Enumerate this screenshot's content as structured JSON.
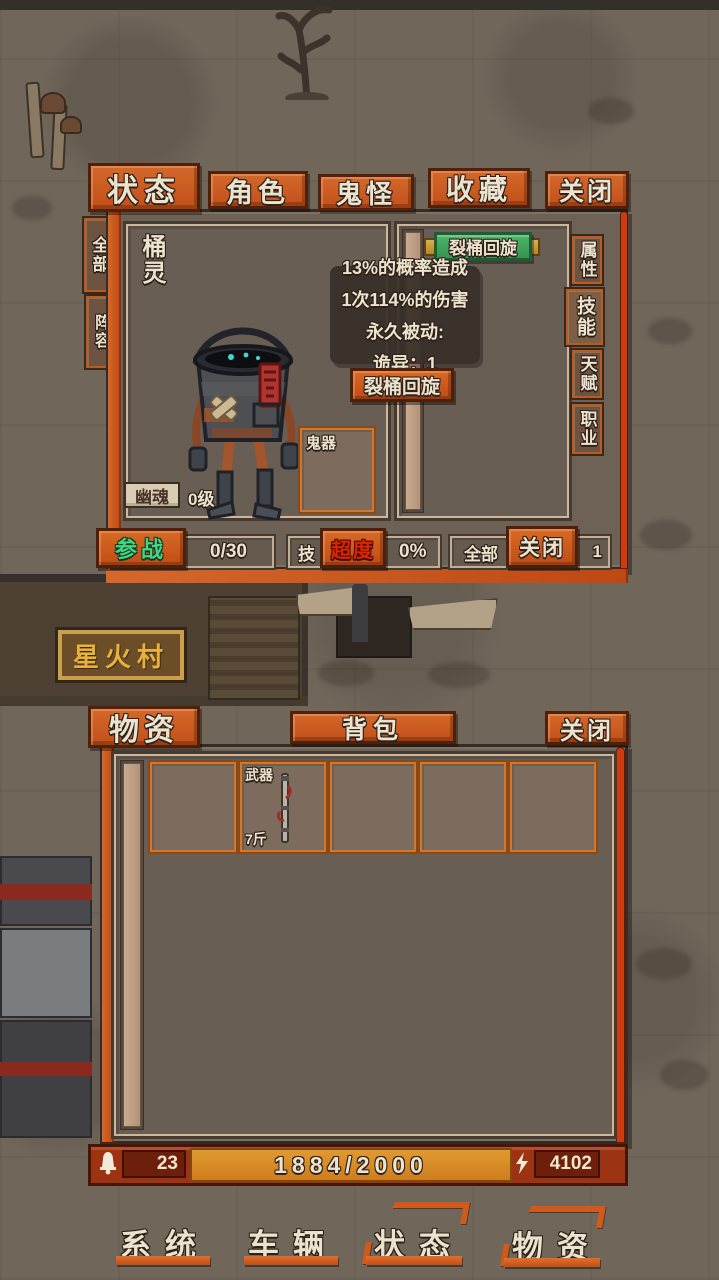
{
  "scene": {
    "village_sign": "星火村"
  },
  "colors": {
    "accent_orange": "#c2501a",
    "banner_green": "#3ca85b",
    "amber": "#d9882a",
    "join_green": "#43d584",
    "transcend_red": "#e02400"
  },
  "status_window": {
    "tabs": [
      {
        "label": "状态"
      },
      {
        "label": "角色"
      },
      {
        "label": "鬼怪"
      },
      {
        "label": "收藏"
      },
      {
        "label": "关闭"
      }
    ],
    "side_tabs_left": [
      {
        "label": "全部"
      },
      {
        "label": "阵容"
      }
    ],
    "side_tabs_right": [
      {
        "label": "属性"
      },
      {
        "label": "技能"
      },
      {
        "label": "天赋"
      },
      {
        "label": "职业"
      }
    ],
    "character": {
      "name": "桶灵",
      "type_badge": "幽魂",
      "level": "0级",
      "equip_slot_label": "鬼器"
    },
    "skill_banner_label": "裂桶回旋",
    "tooltip": {
      "line1": "13%的概率造成",
      "line2": "1次114%的伤害",
      "line3": "永久被动:",
      "line4": "诡异：1",
      "button_label": "裂桶回旋"
    },
    "footer": {
      "join_button": "参战",
      "join_count": "0/30",
      "skill_prefix": "技",
      "transcend_button": "超度",
      "speed_value": "0%",
      "all_prefix": "全部",
      "close_button": "关闭",
      "obscured_suffix": "1"
    }
  },
  "supplies_window": {
    "title_tab": "物资",
    "bag_button": "背包",
    "close_button": "关闭",
    "weapon_slot": {
      "type_label": "武器",
      "weight": "7斤"
    },
    "resource_bar": {
      "bell_count": "23",
      "capacity": "1884/2000",
      "energy": "4102"
    }
  },
  "bottom_nav": [
    {
      "label": "系统"
    },
    {
      "label": "车辆"
    },
    {
      "label": "状态"
    },
    {
      "label": "物资"
    }
  ]
}
